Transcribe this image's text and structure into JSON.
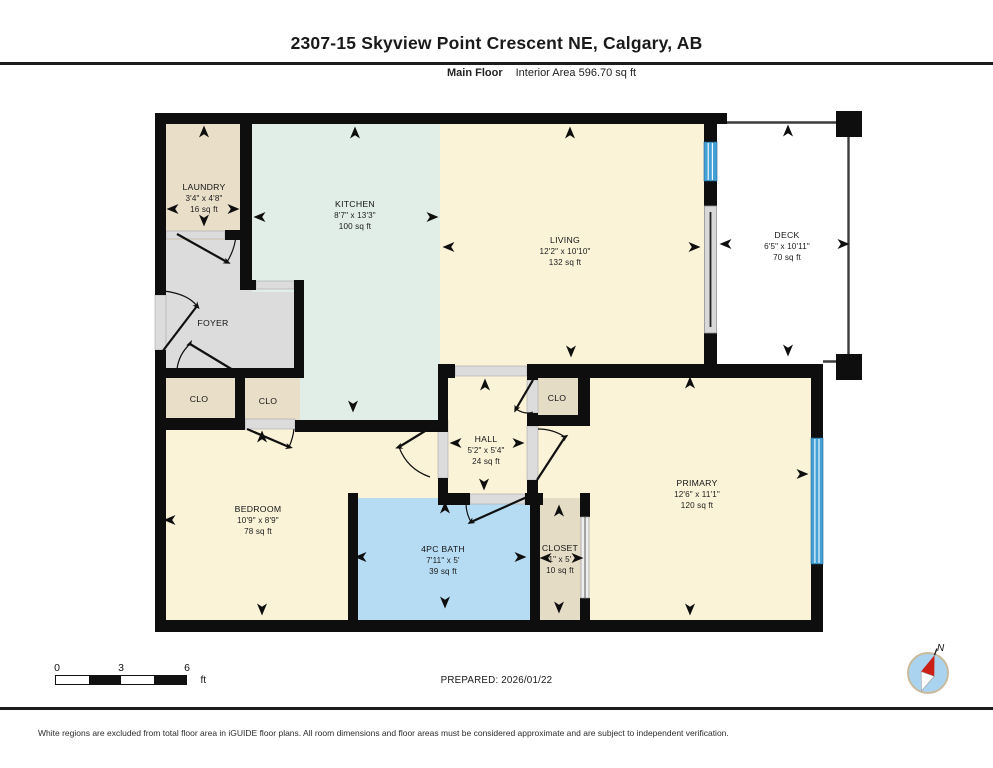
{
  "header": {
    "title": "2307-15 Skyview Point Crescent NE, Calgary, AB",
    "floor_label": "Main Floor",
    "area_label": "Interior Area 596.70 sq ft"
  },
  "rooms": {
    "laundry": {
      "name": "LAUNDRY",
      "dims": "3'4\" x 4'8\"",
      "area": "16 sq ft"
    },
    "kitchen": {
      "name": "KITCHEN",
      "dims": "8'7\" x 13'3\"",
      "area": "100 sq ft"
    },
    "living": {
      "name": "LIVING",
      "dims": "12'2\" x 10'10\"",
      "area": "132 sq ft"
    },
    "deck": {
      "name": "DECK",
      "dims": "6'5\" x 10'11\"",
      "area": "70 sq ft"
    },
    "foyer": {
      "name": "FOYER"
    },
    "clo_foyer": {
      "name": "CLO"
    },
    "clo_bedroom": {
      "name": "CLO"
    },
    "clo_primary": {
      "name": "CLO"
    },
    "hall": {
      "name": "HALL",
      "dims": "5'2\" x 5'4\"",
      "area": "24 sq ft"
    },
    "bedroom": {
      "name": "BEDROOM",
      "dims": "10'9\" x 8'9\"",
      "area": "78 sq ft"
    },
    "bath": {
      "name": "4PC BATH",
      "dims": "7'11\" x 5'",
      "area": "39 sq ft"
    },
    "closet": {
      "name": "CLOSET",
      "dims": "1\" x 5'",
      "area": "10 sq ft"
    },
    "primary": {
      "name": "PRIMARY",
      "dims": "12'6\" x 11'1\"",
      "area": "120 sq ft"
    }
  },
  "scale_bar": {
    "tick_start": "0",
    "tick_mid": "3",
    "tick_end": "6",
    "unit": "ft"
  },
  "compass": {
    "north_label": "N"
  },
  "footer": {
    "prepared": "PREPARED: 2026/01/22",
    "disclaimer": "White regions are excluded from total floor area in iGUIDE floor plans. All room dimensions and floor areas must be considered approximate and are subject to independent verification."
  },
  "colors": {
    "wall": "#0e0e0e",
    "room_cream": "#faf3d8",
    "room_mint": "#e1ede7",
    "room_tan": "#e9dfc9",
    "room_gray": "#dcdcdc",
    "bath_blue": "#b6dcf4",
    "window_blue": "#44a1d8",
    "compass_red": "#cc2016"
  }
}
